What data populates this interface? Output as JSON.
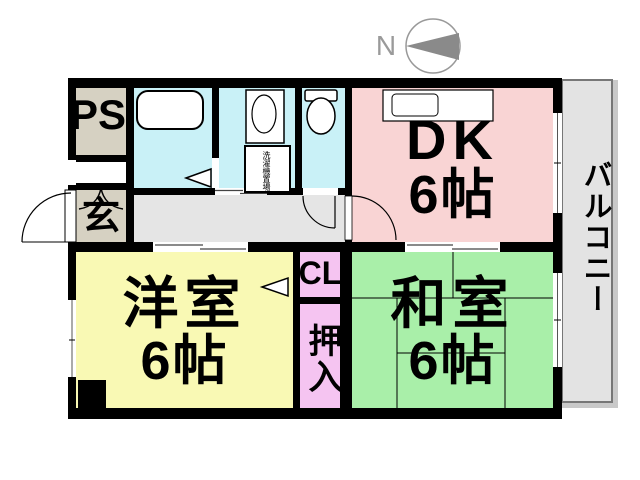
{
  "compass": {
    "north_label": "N"
  },
  "rooms": {
    "ps": {
      "label": "PS"
    },
    "genkan": {
      "label": "玄"
    },
    "dk": {
      "name": "DK",
      "size": "6帖"
    },
    "western": {
      "name": "洋室",
      "size": "6帖"
    },
    "japanese": {
      "name": "和室",
      "size": "6帖"
    },
    "closet": {
      "label": "CL"
    },
    "oshiire": {
      "label": "押入"
    },
    "balcony": {
      "label": "バルコニー"
    },
    "washroom": {
      "washing_machine_label": "洗濯機置場"
    }
  },
  "colors": {
    "wall": "#000000",
    "wet_area": "#c9f1f7",
    "dk": "#f9d4d4",
    "western_room": "#f9f9b4",
    "japanese_room": "#a9efa9",
    "closet": "#f5c4f1",
    "service": "#d6d1c2",
    "hallway": "#e5e5e5",
    "balcony": "#e3e3e3",
    "balcony_edge": "#c9c9c9",
    "compass_arrow": "#8a8a8a"
  }
}
